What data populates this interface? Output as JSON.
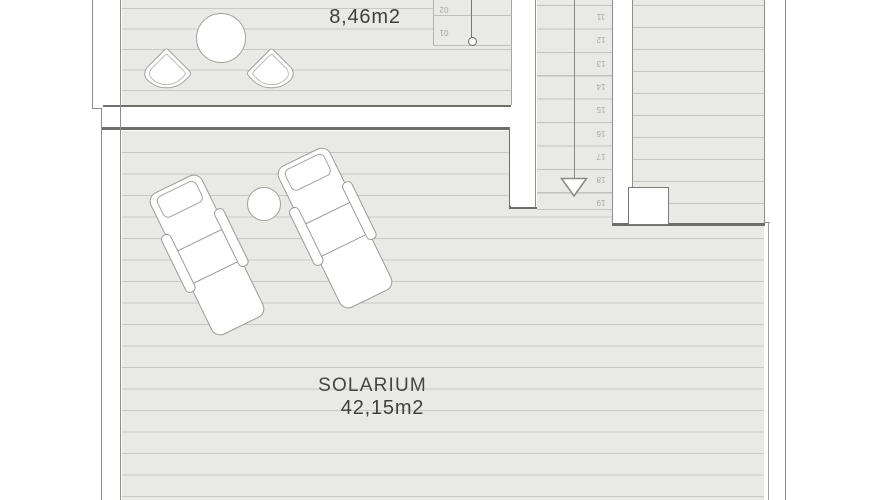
{
  "plan": {
    "title": "roof-terrace-floor-plan",
    "terrace": {
      "name": "TERRAZA",
      "area": "8,46m2"
    },
    "solarium": {
      "name": "SOLARIUM",
      "area": "42,15m2"
    },
    "stairs": {
      "upper_steps": [
        "02",
        "01"
      ],
      "lower_steps": [
        "11",
        "12",
        "13",
        "14",
        "15",
        "16",
        "17",
        "18",
        "19"
      ],
      "direction_arrow": "down-arrow-icon"
    },
    "furniture": [
      "round-table-icon",
      "terrace-chair-icon",
      "terrace-chair-icon",
      "sun-lounger-icon",
      "sun-lounger-icon",
      "side-table-icon"
    ],
    "colors": {
      "deck_fill": "#e9e9e6",
      "deck_line": "#c9c9c4",
      "step_line": "#c2c2bc",
      "wall_outline": "#8f8f8a",
      "border_dark": "#6e6e6a",
      "label_text": "#454543",
      "step_number_text": "#a8a8a2",
      "background": "#ffffff"
    }
  }
}
